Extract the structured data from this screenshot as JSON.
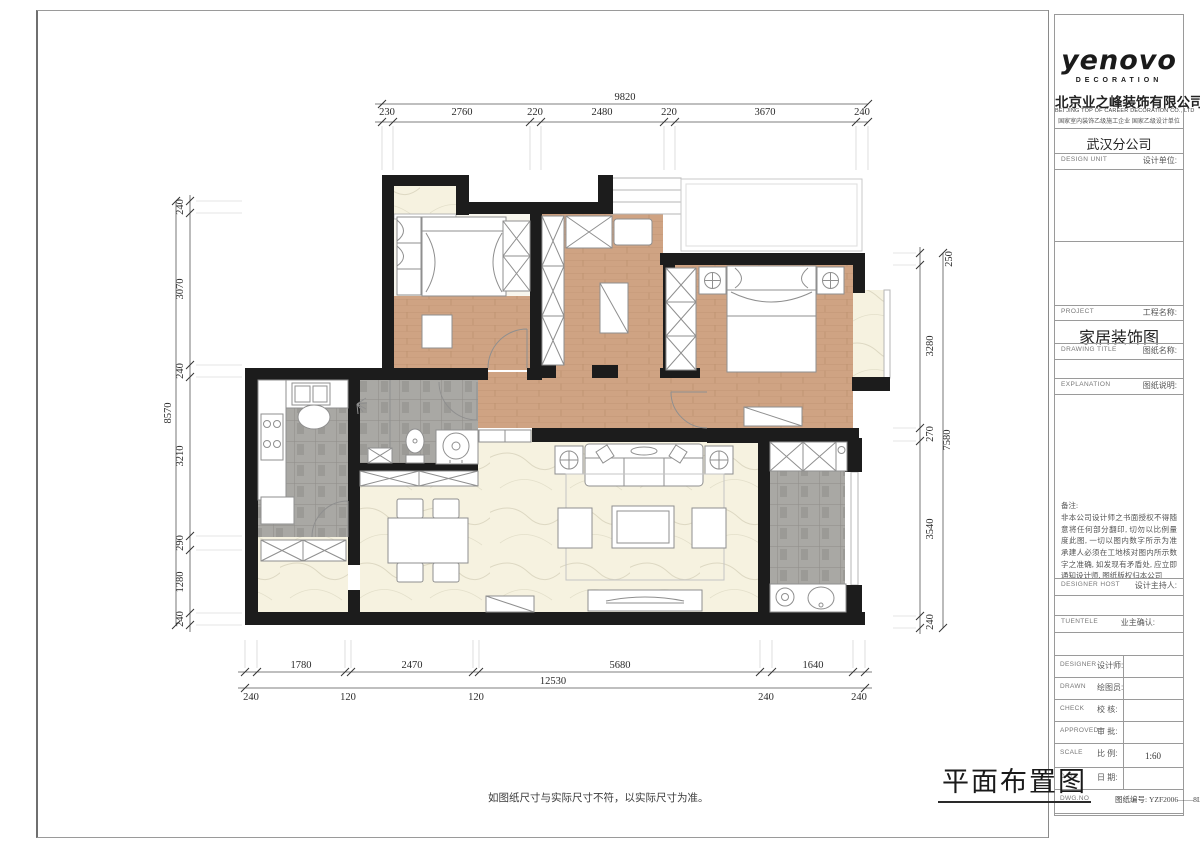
{
  "title_block": {
    "logo_text": "yenovo",
    "logo_sub": "DECORATION",
    "company_cn": "北京业之峰装饰有限公司",
    "company_en": "BEI JING TOP OF CAREER DECORATION CO., LTD",
    "company_certs": "国家室内装饰乙级施工企业  国家乙级设计单位",
    "branch": "武汉分公司",
    "design_unit_en": "DESIGN  UNIT",
    "design_unit_cn": "设计单位:",
    "project_en": "PROJECT",
    "project_cn": "工程名称:",
    "project_value": "家居装饰图",
    "drawing_title_en": "DRAWING  TITLE",
    "drawing_title_cn": "图纸名称:",
    "explanation_en": "EXPLANATION",
    "explanation_cn": "图纸说明:",
    "notes_title": "备注:",
    "notes_text": "非本公司设计师之书面授权不得随意将任何部分翻印, 切勿以比例量度此图, 一切以图内数字所示为准 承建人必须在工地核对图内所示数字之准确, 如发现有矛盾处, 应立即通知设计师, 图纸版权归本公司",
    "designer_host_en": "DESIGNER  HOST",
    "designer_host_cn": "设计主持人:",
    "client_en": "TUENTELE",
    "client_cn": "业主确认:",
    "designer_en": "DESIGNER",
    "designer_cn": "设计师:",
    "drawn_en": "DRAWN",
    "drawn_cn": "绘图员:",
    "check_en": "CHECK",
    "check_cn": "校  核:",
    "approved_en": "APPROVED",
    "approved_cn": "审  批:",
    "scale_en": "SCALE",
    "scale_cn": "比  例:",
    "scale_value": "1:60",
    "date_en": "DATE",
    "date_cn": "日  期:",
    "dwgno_en": "DWG.NO",
    "dwgno_cn": "图纸编号:",
    "dwgno_value": "YZF2006——8L"
  },
  "drawing": {
    "title": "平面布置图",
    "disclaimer": "如图纸尺寸与实际尺寸不符，以实际尺寸为准。"
  },
  "dimensions": {
    "top": {
      "total": "9820",
      "segments": [
        "230",
        "2760",
        "220",
        "2480",
        "220",
        "3670",
        "240"
      ]
    },
    "left": {
      "total": "8570",
      "segments": [
        "240",
        "3070",
        "240",
        "3210",
        "290",
        "1280",
        "240"
      ]
    },
    "right": {
      "total": "7580",
      "segments": [
        "250",
        "3280",
        "270",
        "3540",
        "240"
      ]
    },
    "bottom": {
      "total": "12530",
      "segments": [
        "1780",
        "2470",
        "5680",
        "1640"
      ],
      "edge_segments": [
        "240",
        "120",
        "120",
        "240",
        "240"
      ]
    }
  },
  "colors": {
    "wall": "#1c1c1c",
    "wood_floor": "#cfa383",
    "tile_floor": "#a9a8a4",
    "marble_floor": "#f6f2e0",
    "dim_text": "#2a2a2a"
  }
}
